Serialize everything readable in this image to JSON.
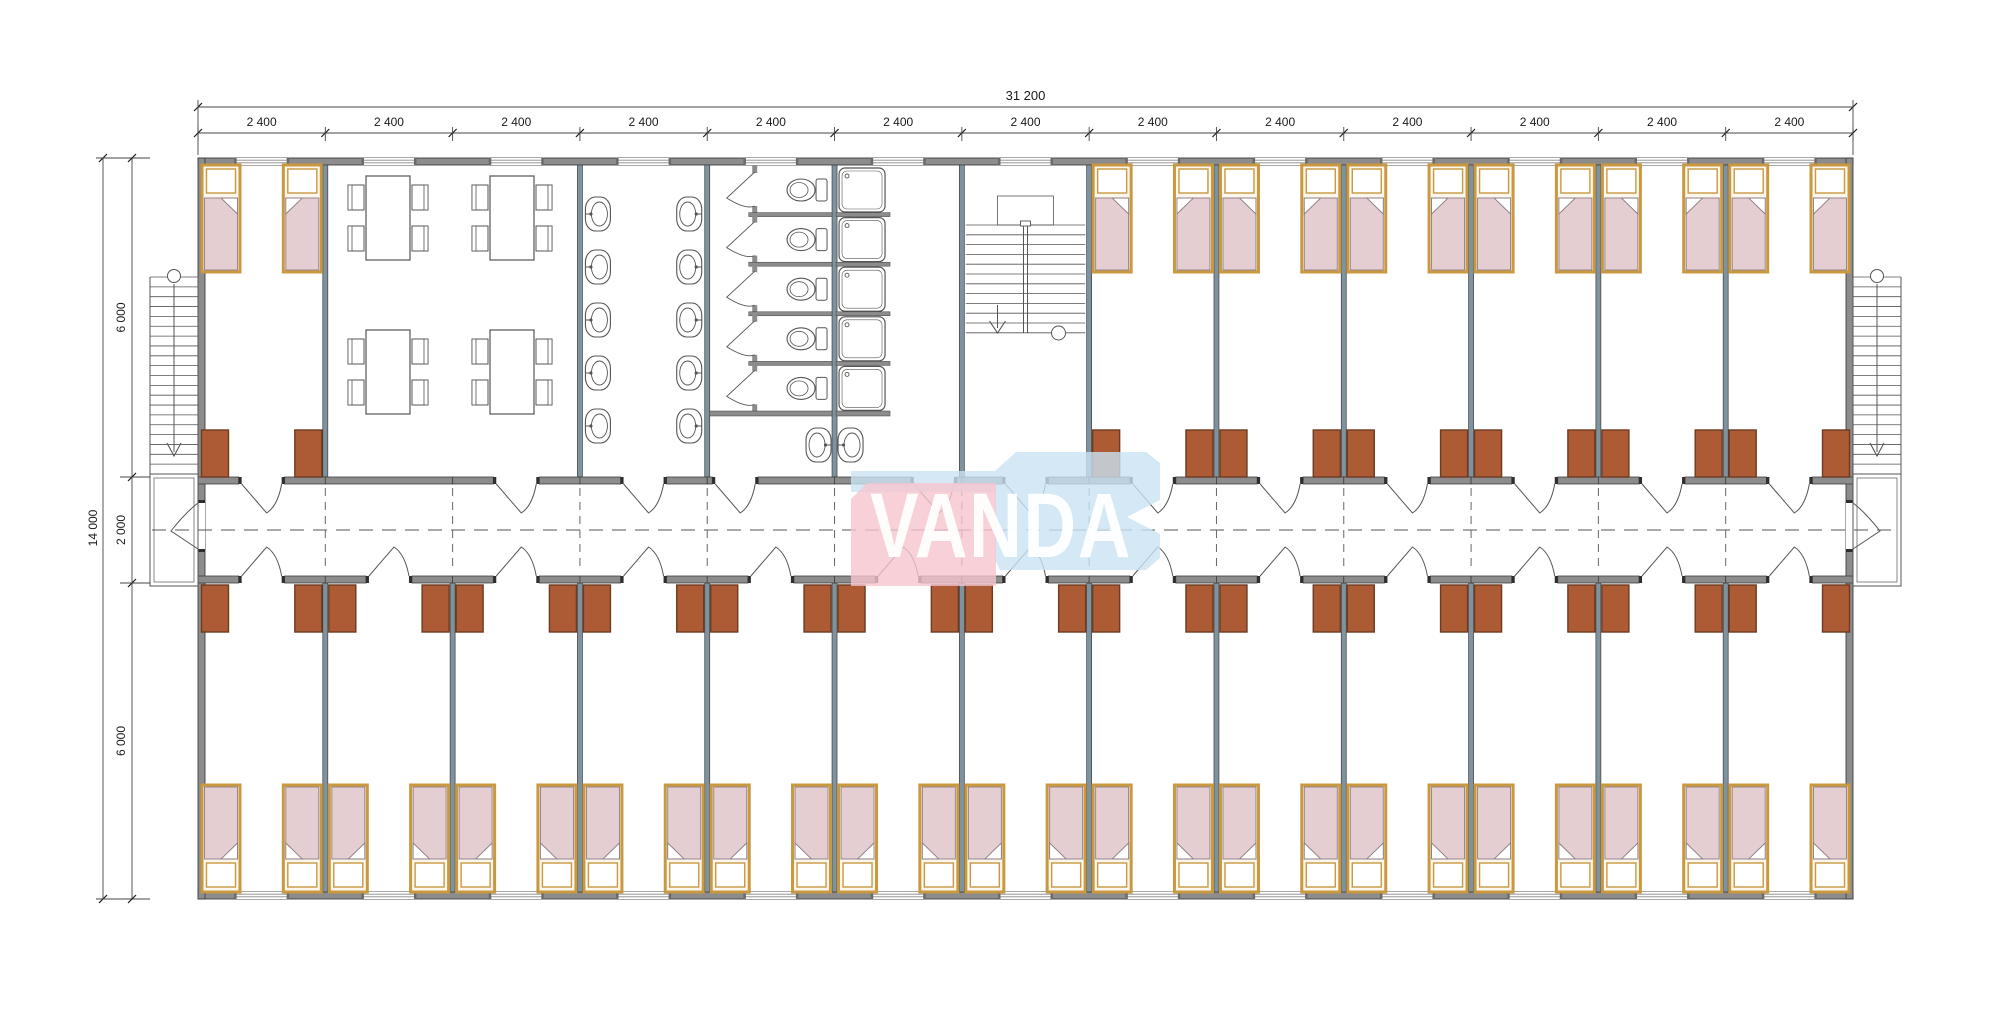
{
  "logo": {
    "text": "VANDA",
    "pink": "#F6C5CE",
    "blue": "#C9E2F2",
    "text_color": "#FFFFFF"
  },
  "dimensions": {
    "top_total_label": "31 200",
    "bay_labels": [
      "2 400",
      "2 400",
      "2 400",
      "2 400",
      "2 400",
      "2 400",
      "2 400",
      "2 400",
      "2 400",
      "2 400",
      "2 400",
      "2 400",
      "2 400"
    ],
    "left_total_label": "14 000",
    "left_segment_labels": [
      "6 000",
      "2 000",
      "6 000"
    ],
    "units_mm": {
      "building_width": 31200,
      "building_depth": 14000,
      "bay_width": 2400,
      "bay_count": 13,
      "room_depth": 6000,
      "corridor_width": 2000
    }
  },
  "program": {
    "top_bays": [
      "dorm",
      "dining",
      "dining",
      "washroom",
      "toilets",
      "showers",
      "stairwell",
      "dorm",
      "dorm",
      "dorm",
      "dorm",
      "dorm",
      "dorm"
    ],
    "bottom_bays": [
      "dorm",
      "dorm",
      "dorm",
      "dorm",
      "dorm",
      "dorm",
      "dorm",
      "dorm",
      "dorm",
      "dorm",
      "dorm",
      "dorm",
      "dorm"
    ],
    "exterior": [
      "left-external-stair",
      "left-entry-landing",
      "right-external-stair",
      "right-entry-landing"
    ]
  },
  "counts": {
    "beds": 40,
    "wardrobes": 40,
    "wash_basins": 12,
    "toilet_stalls": 5,
    "shower_stalls": 5,
    "dining_tables": 4,
    "dining_chairs": 16,
    "internal_stairs": 1,
    "external_stairs": 2,
    "windows": 26
  },
  "colors": {
    "background": "#FFFFFF",
    "outer_wall": "#8C8C8C",
    "partition": "#7E939E",
    "wall_stroke": "#3F3F3F",
    "line": "#555555",
    "dim_line": "#444444",
    "dim_text": "#1A1A1A",
    "bed_frame": "#C9983F",
    "bed_fill": "#FBF7EF",
    "blanket": "#E4CED2",
    "blanket_stroke": "#8D7D81",
    "wardrobe": "#AC5B35",
    "wardrobe_stroke": "#6E3A20",
    "fixture_fill": "#FFFFFF",
    "dash": "#555555"
  }
}
